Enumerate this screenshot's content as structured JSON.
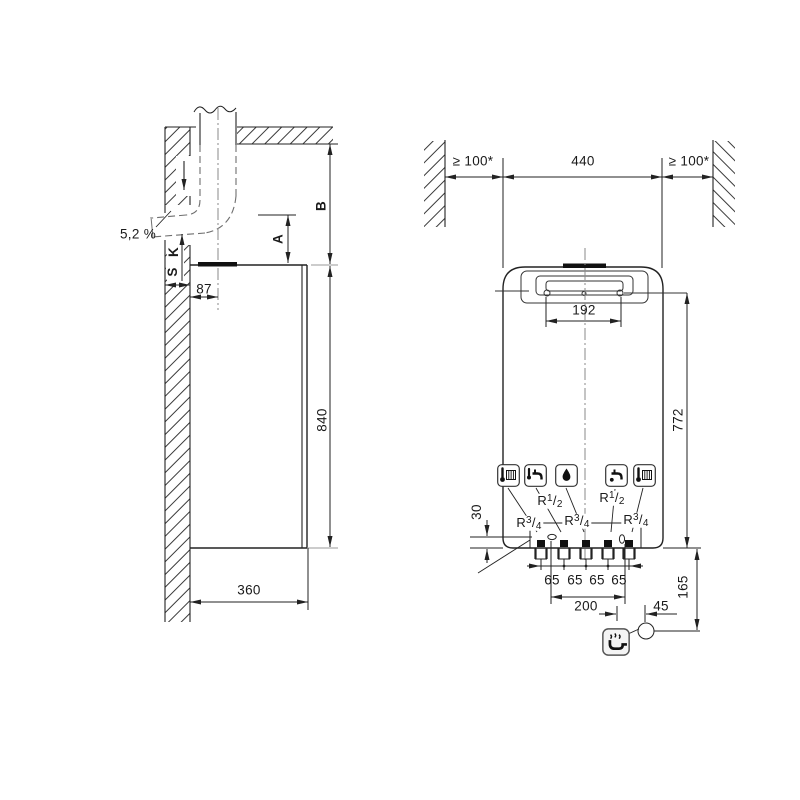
{
  "title": "wall-hung boiler installation dimension drawing",
  "side_view": {
    "slope": "5,2 %",
    "dim_B": "B",
    "dim_A": "A",
    "dim_K": "K",
    "dim_S": "S",
    "dim_87": "87",
    "dim_840": "840",
    "dim_360": "360"
  },
  "front_view": {
    "clearance_left": "≥ 100*",
    "width": "440",
    "clearance_right": "≥ 100*",
    "bracket_holes": "192",
    "dim_772": "772",
    "dim_30": "30",
    "spacing_65": [
      "65",
      "65",
      "65",
      "65"
    ],
    "dim_200": "200",
    "dim_45": "45",
    "dim_165": "165"
  },
  "connections": [
    {
      "p": "R",
      "n": "3",
      "s": "/",
      "d": "4"
    },
    {
      "p": "R",
      "n": "1",
      "s": "/",
      "d": "2"
    },
    {
      "p": "R",
      "n": "3",
      "s": "/",
      "d": "4"
    },
    {
      "p": "R",
      "n": "1",
      "s": "/",
      "d": "2"
    },
    {
      "p": "R",
      "n": "3",
      "s": "/",
      "d": "4"
    }
  ],
  "icons": {
    "heating_flow": "radiator-thermometer-icon",
    "hot_water": "tap-thermometer-icon",
    "gas": "gas-drop-icon",
    "cold_water": "tap-drop-icon",
    "heating_return": "radiator-thermometer-icon",
    "condensate": "siphon-icon"
  },
  "colors": {
    "line": "#222222",
    "hidden_line": "#6e6e6e",
    "centerline": "#8a8a8a",
    "background": "#ffffff"
  }
}
